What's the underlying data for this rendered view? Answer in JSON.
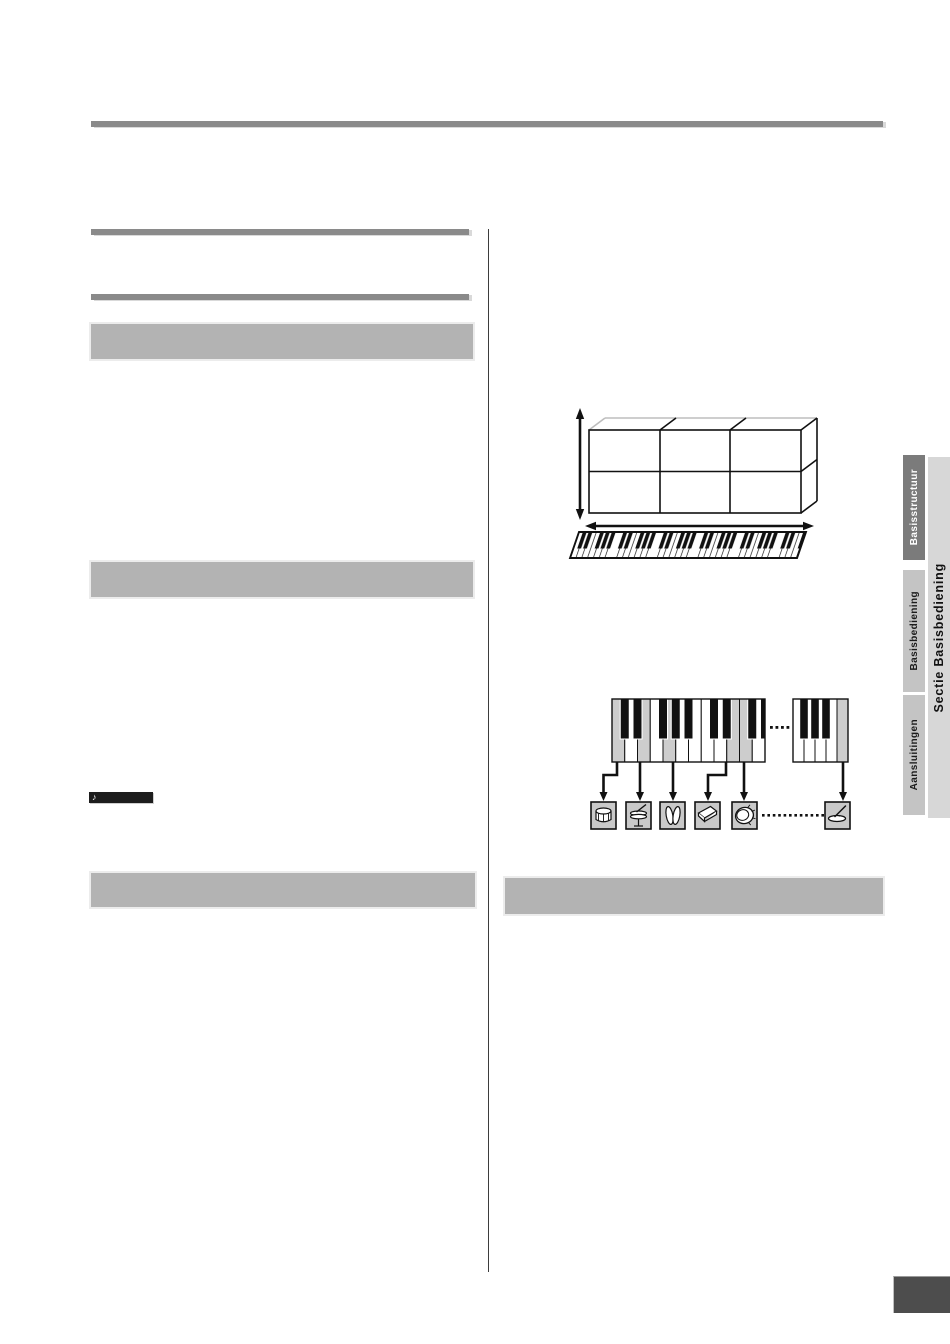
{
  "page": {
    "background": "#ffffff",
    "divider_color": "#3d3d3d",
    "rule_color": "#8a8a8a",
    "heading_bar_color": "#b3b3b3",
    "page_marker_color": "#4d4d4d"
  },
  "note_badge": {
    "icon": "eighth-note-icon",
    "glyph": "♪",
    "bg": "#1d1d1d"
  },
  "sidebar_tabs": {
    "inner": [
      {
        "label": "Basisstructuur",
        "active": true,
        "bg": "#7b7b7b",
        "text_color": "#ffffff"
      },
      {
        "label": "Basisbediening",
        "active": false,
        "bg": "#c4c4c4",
        "text_color": "#1c1c1c"
      },
      {
        "label": "Aansluitingen",
        "active": false,
        "bg": "#c4c4c4",
        "text_color": "#1c1c1c"
      }
    ],
    "outer": {
      "label": "Sectie Basisbediening",
      "bg": "#d7d7d7",
      "text_color": "#111111"
    }
  },
  "diagrams": {
    "voice_structure": {
      "grid_rows": 2,
      "grid_cols": 3,
      "arrows": [
        "vertical-double-arrow",
        "horizontal-double-arrow"
      ],
      "keyboard": "skewed-piano-strip"
    },
    "drum_kit_map": {
      "left_keyboard_white_keys": 12,
      "left_shaded_keys": [
        0,
        2,
        4,
        9,
        10
      ],
      "right_keyboard_white_keys": 5,
      "right_shaded_keys": [
        4
      ],
      "icons": [
        "snare-drum",
        "hi-hat",
        "hand-cymbals",
        "cowbell",
        "tambourine",
        "cymbal"
      ],
      "icon_box_bg": "#c9c9c9"
    }
  }
}
